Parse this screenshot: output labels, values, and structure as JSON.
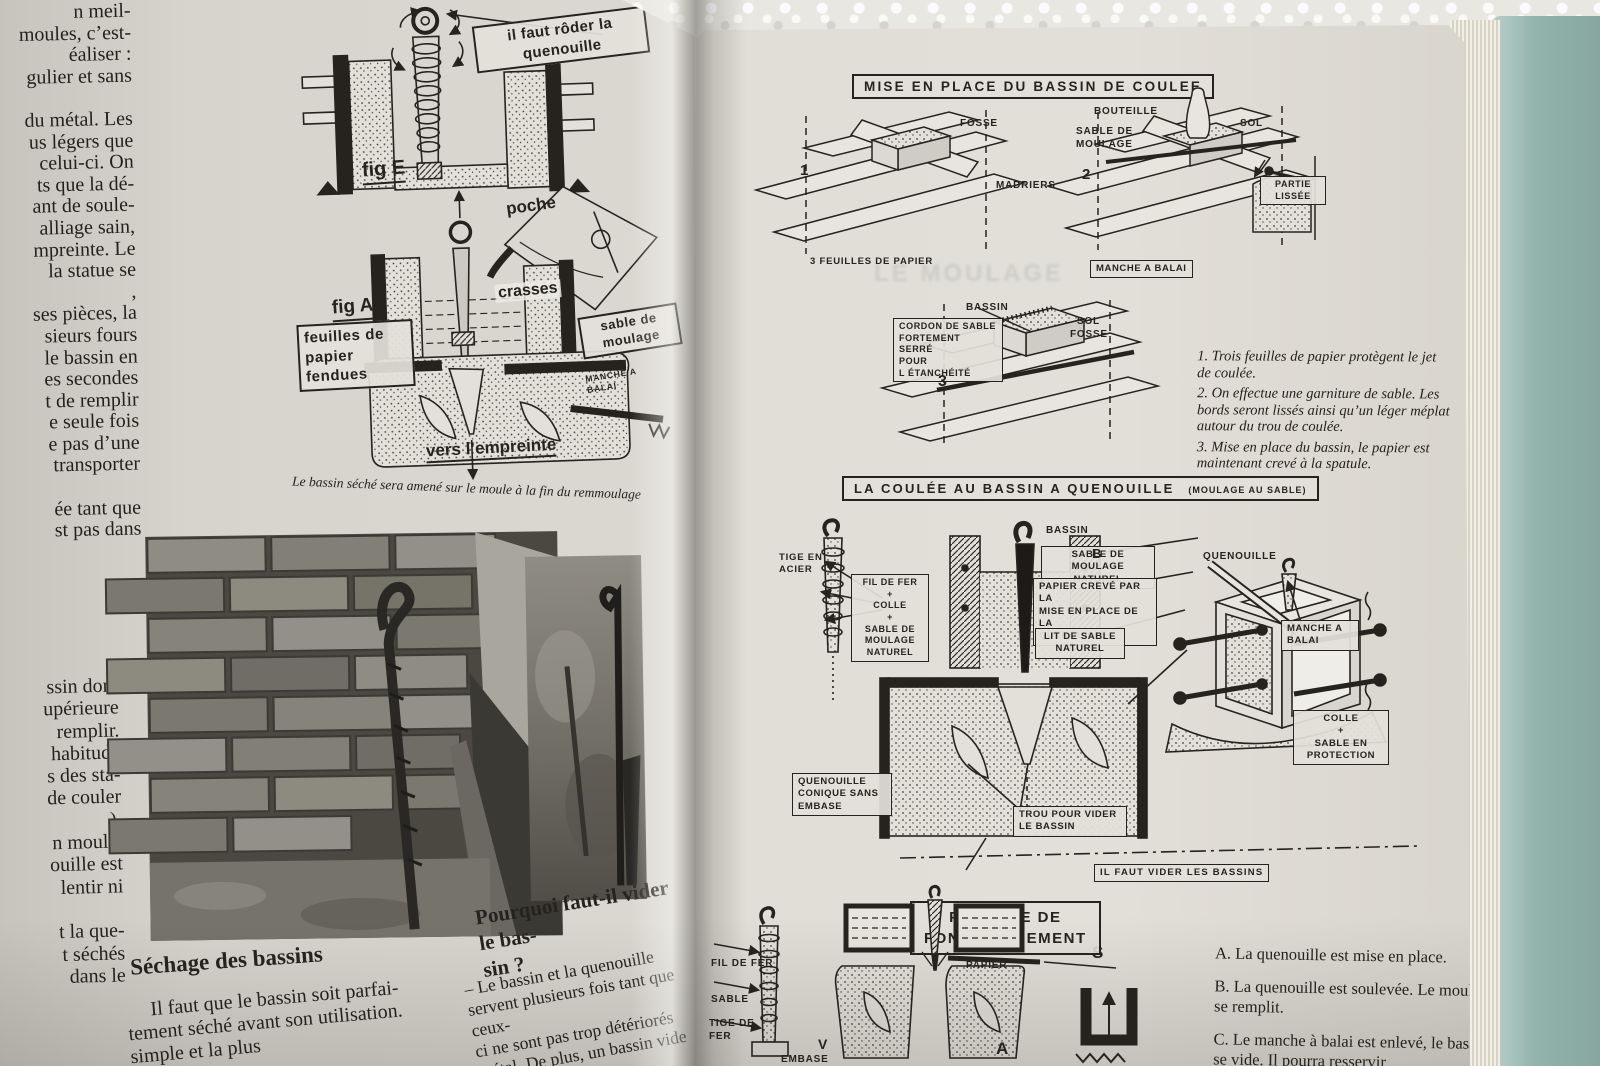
{
  "book": {
    "left": {
      "col_top": "n meil-\nmoules, c’est-\néaliser :\ngulier et sans\n\ndu métal. Les\nus légers que\ncelui-ci. On\nts que la dé-\nant de soule-\nalliage sain,\nmpreinte. Le\nla statue se\n,\nses pièces, la\nsieurs fours\nle bassin en\nes secondes\nt de remplir\ne seule fois\ne pas d’une\ntransporter\n\née tant que\nst pas dans",
      "col_bottom": "ssin dont\nupérieure\nremplir.\nhabitude\ns des sta-\nde couler\n).\nn moule.\nouille est\nlentir ni\n\nt la que-\nt séchés\ndans le",
      "fig_e_label": "il faut rôder la\nquenouille",
      "fig_e_caption": "fig E",
      "fig_a_caption": "fig A",
      "poche": "poche",
      "crasses": "crasses",
      "sable_moulage": "sable de\nmoulage",
      "feuilles_fendues": "feuilles de\npapier\nfendues",
      "manche_small": "MANCHE A\nBALAI",
      "vers_empreinte": "vers l’empreinte",
      "caption": "Le bassin séché sera amené sur le moule à la fin du remmoulage",
      "sechage_heading": "Séchage des bassins",
      "sechage_body": "Il faut que le bassin soit parfai-\ntement séché avant son utilisation.\nsimple et la plus",
      "pourquoi_heading": "Pourquoi faut-il vider le bas-\nsin ?",
      "pourquoi_body": "–  Le bassin et la quenouille\nservent plusieurs fois tant que ceux-\nci ne sont pas trop détériorés\nmétal. De plus, un bassin vide\nlement le décochage"
    },
    "right": {
      "ghost": "LE MOULAGE",
      "title1": "MISE EN PLACE DU BASSIN DE COULEE",
      "num1": "1",
      "num2": "2",
      "num3": "3",
      "fosse1": "FOSSE",
      "madriers": "MADRIERS",
      "feuilles_papier": "3 FEUILLES DE PAPIER",
      "bouteille": "BOUTEILLE",
      "sable_moulage2": "SABLE DE\nMOULAGE",
      "sol1": "SOL",
      "partie_lissee": "PARTIE\nLISSÉE",
      "manche1": "MANCHE A BALAI",
      "bassin3": "BASSIN",
      "sol2": "SOL",
      "fosse2": "FOSSE",
      "cordon": "CORDON DE SABLE\nFORTEMENT SERRÉ\nPOUR\nL ÉTANCHÉITÉ",
      "step1": "1.  Trois feuilles de papier protègent le jet\nde coulée.",
      "step2": "2.  On effectue une garniture de sable. Les\nbords seront lissés ainsi qu’un léger méplat\nautour du trou de coulée.",
      "step3": "3.  Mise en place du bassin, le papier est\nmaintenant crevé à la spatule.",
      "title2": "LA COULÉE AU BASSIN A QUENOUILLE",
      "title2_paren": "(MOULAGE AU SABLE)",
      "tige_acier": "TIGE EN\nACIER",
      "fil_de_fer": "FIL DE FER\n+\nCOLLE\n+\nSABLE DE\nMOULAGE\nNATUREL",
      "bassin4": "BASSIN",
      "sable_naturel": "SABLE DE MOULAGE\nNATUREL",
      "papier_creve": "PAPIER CREVÉ PAR LA\nMISE EN PLACE DE LA\nQUENOUILLE",
      "lit_sable": "LIT DE SABLE\nNATUREL",
      "quenouille": "QUENOUILLE",
      "manche2": "MANCHE A\nBALAI",
      "colle_sable": "COLLE\n+\nSABLE EN\nPROTECTION",
      "quen_conique": "QUENOUILLE\nCONIQUE SANS\nEMBASE",
      "trou_vider": "TROU POUR VIDER\nLE BASSIN",
      "il_faut_vider": "IL FAUT VIDER LES BASSINS",
      "letter_b": "B",
      "letter_s": "S",
      "letter_v": "V",
      "letter_a": "A",
      "title3": "PRINCIPE DE\nFONCTIONNEMENT",
      "fil2": "FIL DE FER",
      "sable3": "SABLE",
      "tige_fer": "TIGE DE\nFER",
      "papier2": "PAPIER",
      "embase": "EMBASE",
      "abc_a": "A.  La quenouille est mise en place.",
      "abc_b": "B.  La quenouille est soulevée. Le moule\nse remplit.",
      "abc_c": "C.  Le manche à balai est enlevé, le bassin\nse vide. Il pourra resservir."
    }
  }
}
